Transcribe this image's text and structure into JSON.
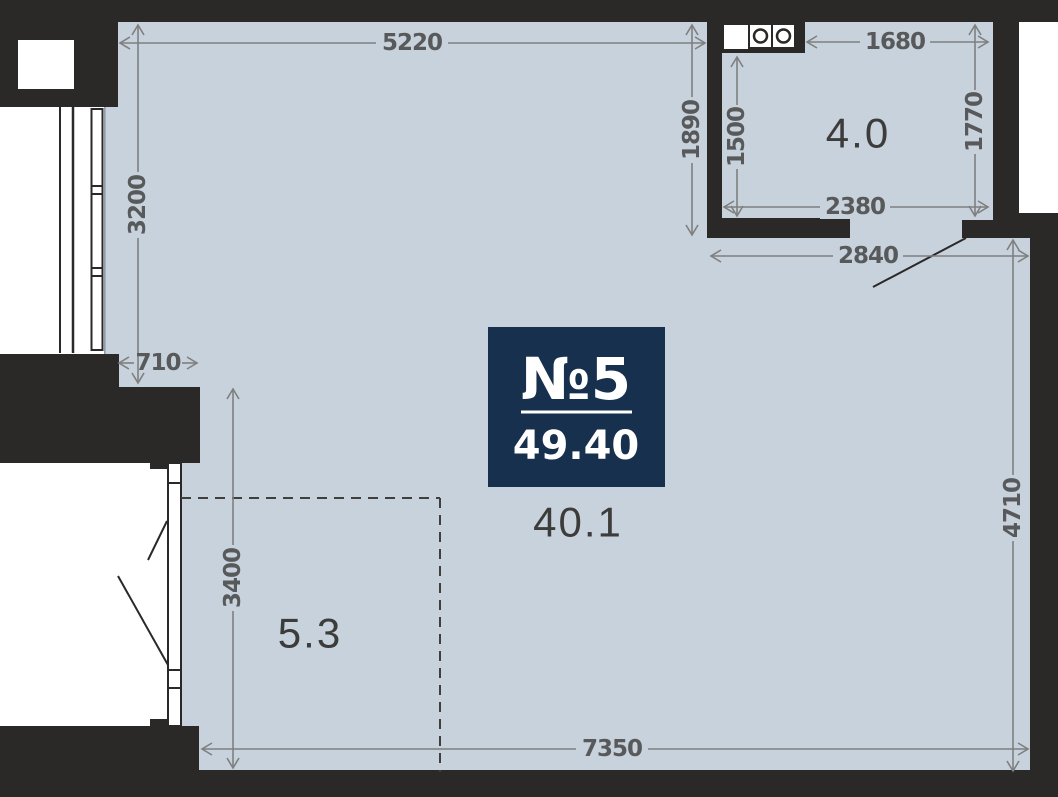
{
  "badge": {
    "unit_label": "№5",
    "total_area": "49.40"
  },
  "areas": {
    "main_room": "40.1",
    "kitchen_zone": "4.0",
    "hall_zone": "5.3"
  },
  "dimensions": {
    "top_main_width": "5220",
    "kitchen_top_width": "1680",
    "kitchen_outer_height": "1890",
    "kitchen_inner_height": "1500",
    "kitchen_right_height": "1770",
    "kitchen_inner_width": "2380",
    "passage_width": "2840",
    "left_upper_height": "3200",
    "wall_step_width": "710",
    "hall_zone_height": "3400",
    "right_side_height": "4710",
    "bottom_width": "7350"
  },
  "colors": {
    "wall": "#2a2928",
    "floor": "#c7d2dc",
    "accent": "#16304d",
    "dim-line": "#7f7f7f",
    "dim-text": "#58595a",
    "room-label": "#3c3c3b"
  }
}
